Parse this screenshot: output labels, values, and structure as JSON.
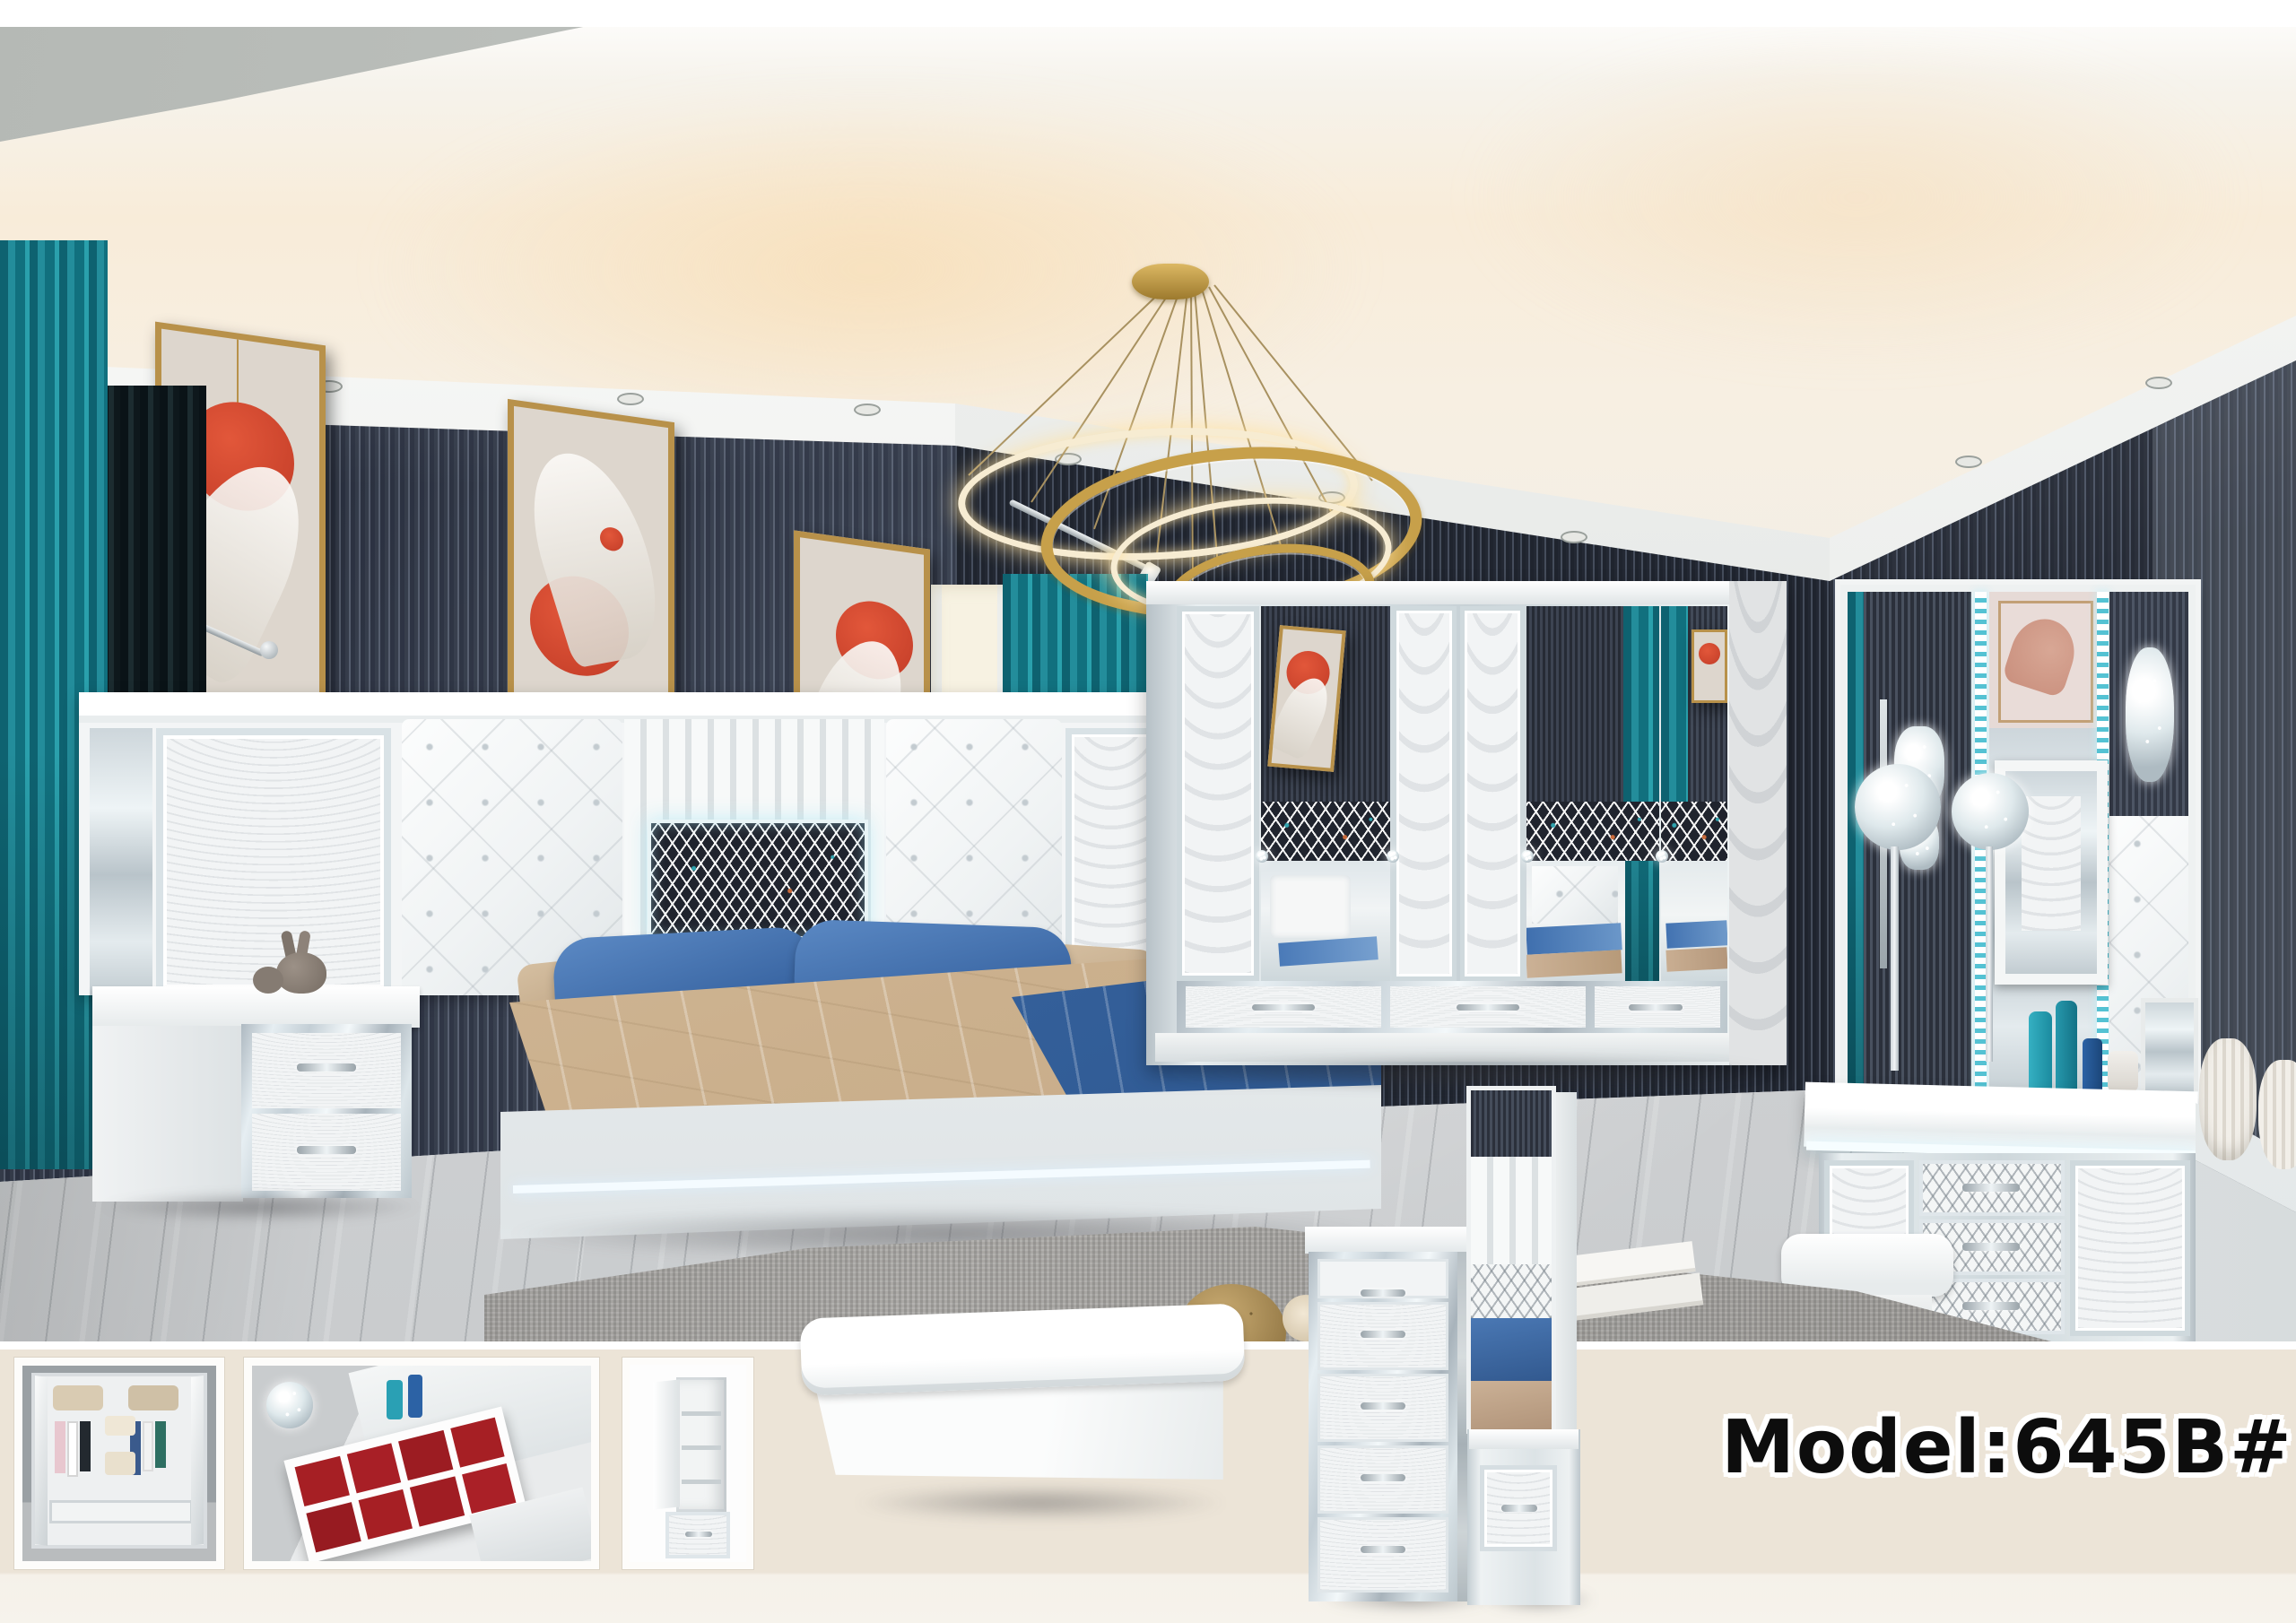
{
  "caption": {
    "text": "Model:645B#"
  },
  "scene": {
    "type": "product-photo",
    "subject": "white mirrored bedroom furniture set in showroom",
    "items": [
      "ring-chandelier",
      "wall-art-triptych",
      "teal-curtains",
      "slatted-accent-wall",
      "cove-ceiling",
      "mirrored-headboard-wall",
      "platform-bed",
      "nightstand",
      "rabbit-figurine",
      "dog-figurine",
      "six-door-mirrored-wardrobe",
      "vanity-dresser-with-mirrors",
      "crystal-candle-stands",
      "vanity-stool",
      "shag-rug",
      "knit-pouf",
      "rose-bouquet",
      "books",
      "storage-bench",
      "five-drawer-chest",
      "mirror-stand"
    ]
  },
  "gallery": {
    "thumbnails": [
      {
        "label": "wardrobe-interior-open"
      },
      {
        "label": "jewelry-drawer-organizer"
      },
      {
        "label": "side-cabinet-open"
      }
    ]
  },
  "colors": {
    "accent_teal": "#1c8494",
    "wall_dark": "#2b303b",
    "gold": "#c7a04a",
    "beige_strip": "#ece4d7",
    "bedding_blue": "#4a7bb8",
    "bedding_tan": "#d3bb9b",
    "velvet_red": "#a61f24"
  }
}
